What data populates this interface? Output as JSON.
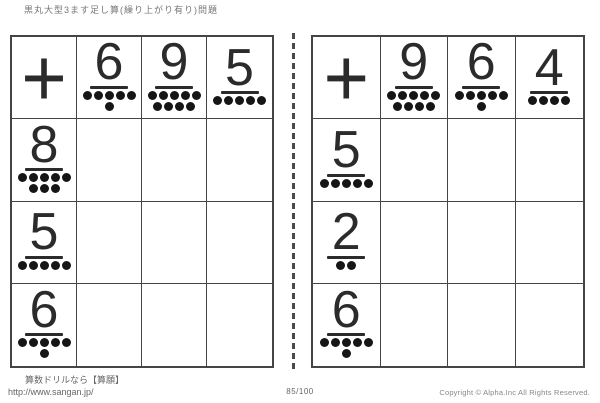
{
  "title": "黒丸大型3ます足し算(繰り上がり有り)問題",
  "footer": {
    "site_label": "算数ドリルなら【算願】",
    "site_url": "http://www.sangan.jp/",
    "page_number": "85/100",
    "copyright": "Copyright © Alpha.Inc All Rights Reserved."
  },
  "grids": [
    {
      "position": "left",
      "operator": "+",
      "columns": [
        {
          "value": "6",
          "dot_rows": [
            5,
            1
          ]
        },
        {
          "value": "9",
          "dot_rows": [
            5,
            4
          ]
        },
        {
          "value": "5",
          "dot_rows": [
            5
          ]
        }
      ],
      "rows": [
        {
          "value": "8",
          "dot_rows": [
            5,
            3
          ]
        },
        {
          "value": "5",
          "dot_rows": [
            5
          ]
        },
        {
          "value": "6",
          "dot_rows": [
            5,
            1
          ]
        }
      ]
    },
    {
      "position": "right",
      "operator": "+",
      "columns": [
        {
          "value": "9",
          "dot_rows": [
            5,
            4
          ]
        },
        {
          "value": "6",
          "dot_rows": [
            5,
            1
          ]
        },
        {
          "value": "4",
          "dot_rows": [
            4
          ]
        }
      ],
      "rows": [
        {
          "value": "5",
          "dot_rows": [
            5
          ]
        },
        {
          "value": "2",
          "dot_rows": [
            2
          ]
        },
        {
          "value": "6",
          "dot_rows": [
            5,
            1
          ]
        }
      ]
    }
  ],
  "colors": {
    "grid_line": "#454545",
    "digit_text": "#2b2b2b",
    "dot": "#161616",
    "muted_text": "#777777",
    "background": "#ffffff"
  }
}
